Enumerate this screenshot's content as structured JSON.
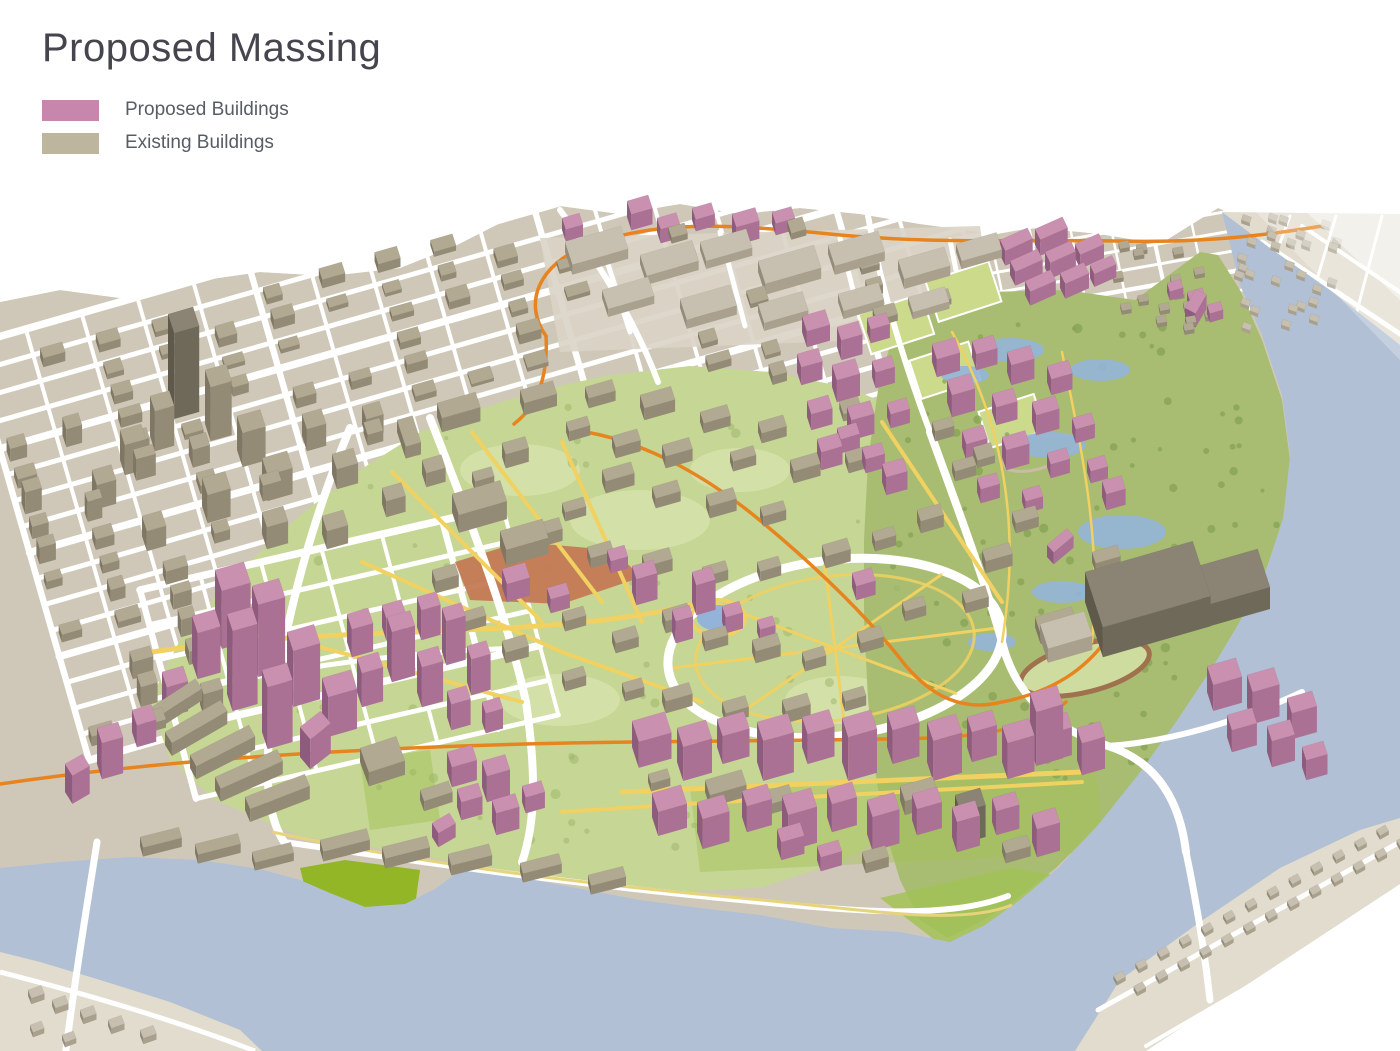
{
  "page": {
    "title": "Proposed Massing",
    "title_color": "#45454d",
    "label_color": "#575d64",
    "frame_color": "#4a4a4a",
    "background": "#ffffff"
  },
  "legend": {
    "items": [
      {
        "id": "proposed",
        "label": "Proposed Buildings",
        "color": "#c786ab"
      },
      {
        "id": "existing",
        "label": "Existing Buildings",
        "color": "#beb59e"
      }
    ]
  },
  "map": {
    "description": "Aerial axonometric massing rendering: proposed pink buildings and existing tan buildings across a campus bounded by a city grid, parkland and water",
    "palette": {
      "water": "#b1c0d5",
      "land": "#cfc8b8",
      "land_light": "#e2dccf",
      "street": "#ffffff",
      "campus_green": "#c6d694",
      "lawn_light": "#d6e2ab",
      "park_green": "#a9bd72",
      "tree_green": "#87a355",
      "bright_green": "#8fb51e",
      "field_green": "#ccda8c",
      "court_green": "#a2c256",
      "path_yellow": "#f0d161",
      "coast_yellow": "#e6d47c",
      "transit_orange": "#e8841f",
      "plaza_terracotta": "#c47a55",
      "pond_blue": "#93b4d8",
      "track_brown": "#a0714d",
      "industrial_ground": "#dad4c7",
      "proposed_top": "#ca90af",
      "proposed_front": "#aa7195",
      "proposed_side": "#8d5b7c",
      "existing_top": "#b2a992",
      "existing_front": "#948b76",
      "existing_side": "#7f7663",
      "dark_top": "#8b8474",
      "dark_front": "#6f695a",
      "dark_side": "#5f594c",
      "light_top": "#c7c0b0",
      "light_front": "#a9a18e",
      "light_side": "#948c7a"
    }
  }
}
